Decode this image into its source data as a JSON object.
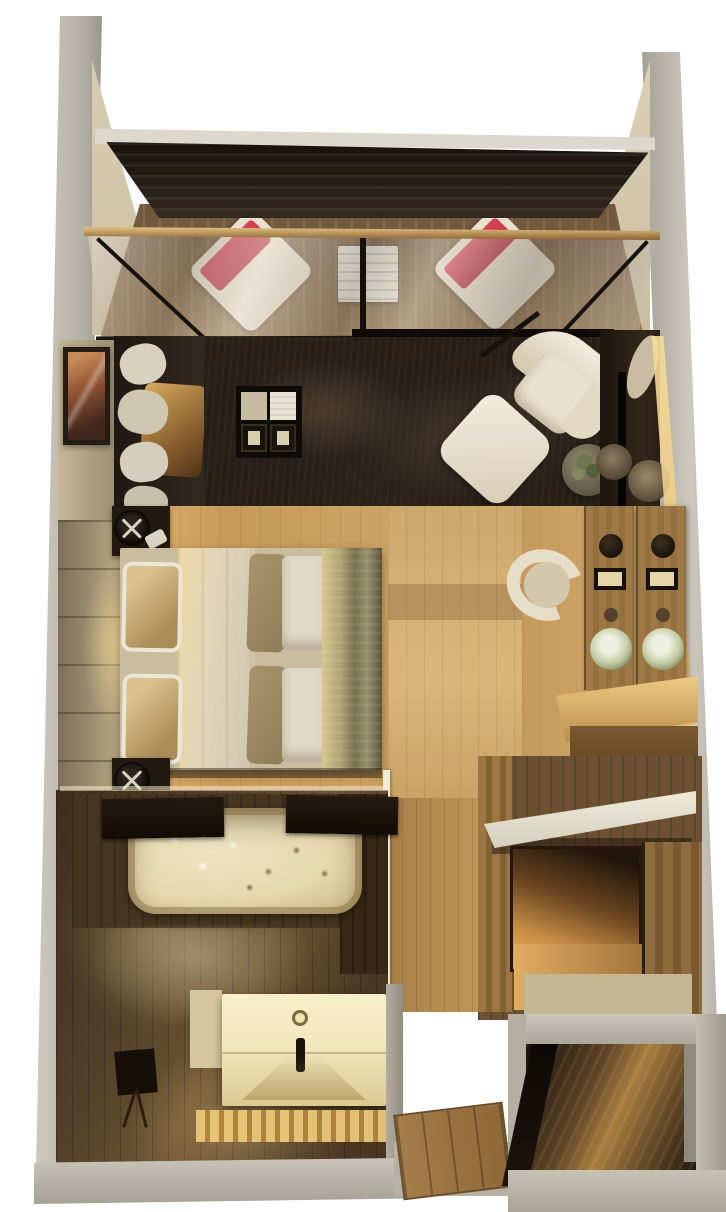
{
  "meta": {
    "title": "Top-down 3D render of a compact studio suite floor plan",
    "render_type": "photorealistic 3D floor plan render",
    "view": "top-down"
  },
  "palette": {
    "bg": "#ffffff",
    "wall": "#b5b1a6",
    "wallLight": "#cdc9be",
    "beigeFace": "#cfc2a6",
    "roof": "#17120d",
    "deck": "#7e6243",
    "brass": "#8a6232",
    "red": "#b6293a",
    "rug": "#271f18",
    "woodLiving": "#a8824e",
    "woodBed": "#c79a58",
    "woodCorridor": "#cda86c",
    "tileWall": "#9c8e72",
    "glow": "#f5dd9b",
    "cream": "#e9e1cd",
    "duvet": "#dfd5ba",
    "gold": "#b2a474",
    "blanket": "#a8946c",
    "bathFloor": "#55412a",
    "deckDark": "#46351f",
    "tub": "#eee3c2",
    "vanityLit": "#f7eecb",
    "doorWood": "#a57c4a",
    "entryFloor": "#a87e40",
    "plant": "#6e7a4c",
    "flower": "#eef0e2",
    "mirrorWood": "#a07a46",
    "slab": "#f0ebdb",
    "nicheGlow": "#eab063"
  },
  "regions": {
    "balcony": {
      "name": "Balcony terrace",
      "items": [
        "roof overhang",
        "wood deck",
        "lounge chair with red cushion (left)",
        "slatted side table",
        "lounge chair with red cushion (right)",
        "brass-framed sliding glass doors"
      ]
    },
    "living_room": {
      "name": "Living room",
      "items": [
        "framed artwork",
        "chaise with cushions and satin throw",
        "dark shag rug",
        "coffee table with trays",
        "floor lamp",
        "cream swivel armchair",
        "cream ottoman",
        "round side table with plant",
        "media console with TV",
        "accent lighting cove"
      ]
    },
    "bedroom": {
      "name": "Bedroom",
      "items": [
        "stone tile accent wall",
        "nightstand with round lamp (top)",
        "double bed with pillows, duvet and gold throw",
        "nightstand with round lamp (bottom)"
      ]
    },
    "dressing_area": {
      "name": "Dressing area",
      "items": [
        "cream vanity chair",
        "wood-framed mirror (left)",
        "wood-framed mirror (right)",
        "flower bouquets",
        "vanity desk"
      ]
    },
    "closet_nook": {
      "name": "Closet nook",
      "items": [
        "white counter ledge",
        "lit wardrobe niche",
        "wood cabinet"
      ]
    },
    "bathroom": {
      "name": "Bathroom",
      "items": [
        "jacuzzi bathtub",
        "wood bath mat (left)",
        "wood bath mat (right)",
        "glossy floor reflection",
        "double sink vanity",
        "lit wood slat floor",
        "stool",
        "wood entry door"
      ]
    },
    "entry": {
      "name": "Entry hall",
      "items": [
        "entry hall floor",
        "open door shadow"
      ]
    }
  }
}
